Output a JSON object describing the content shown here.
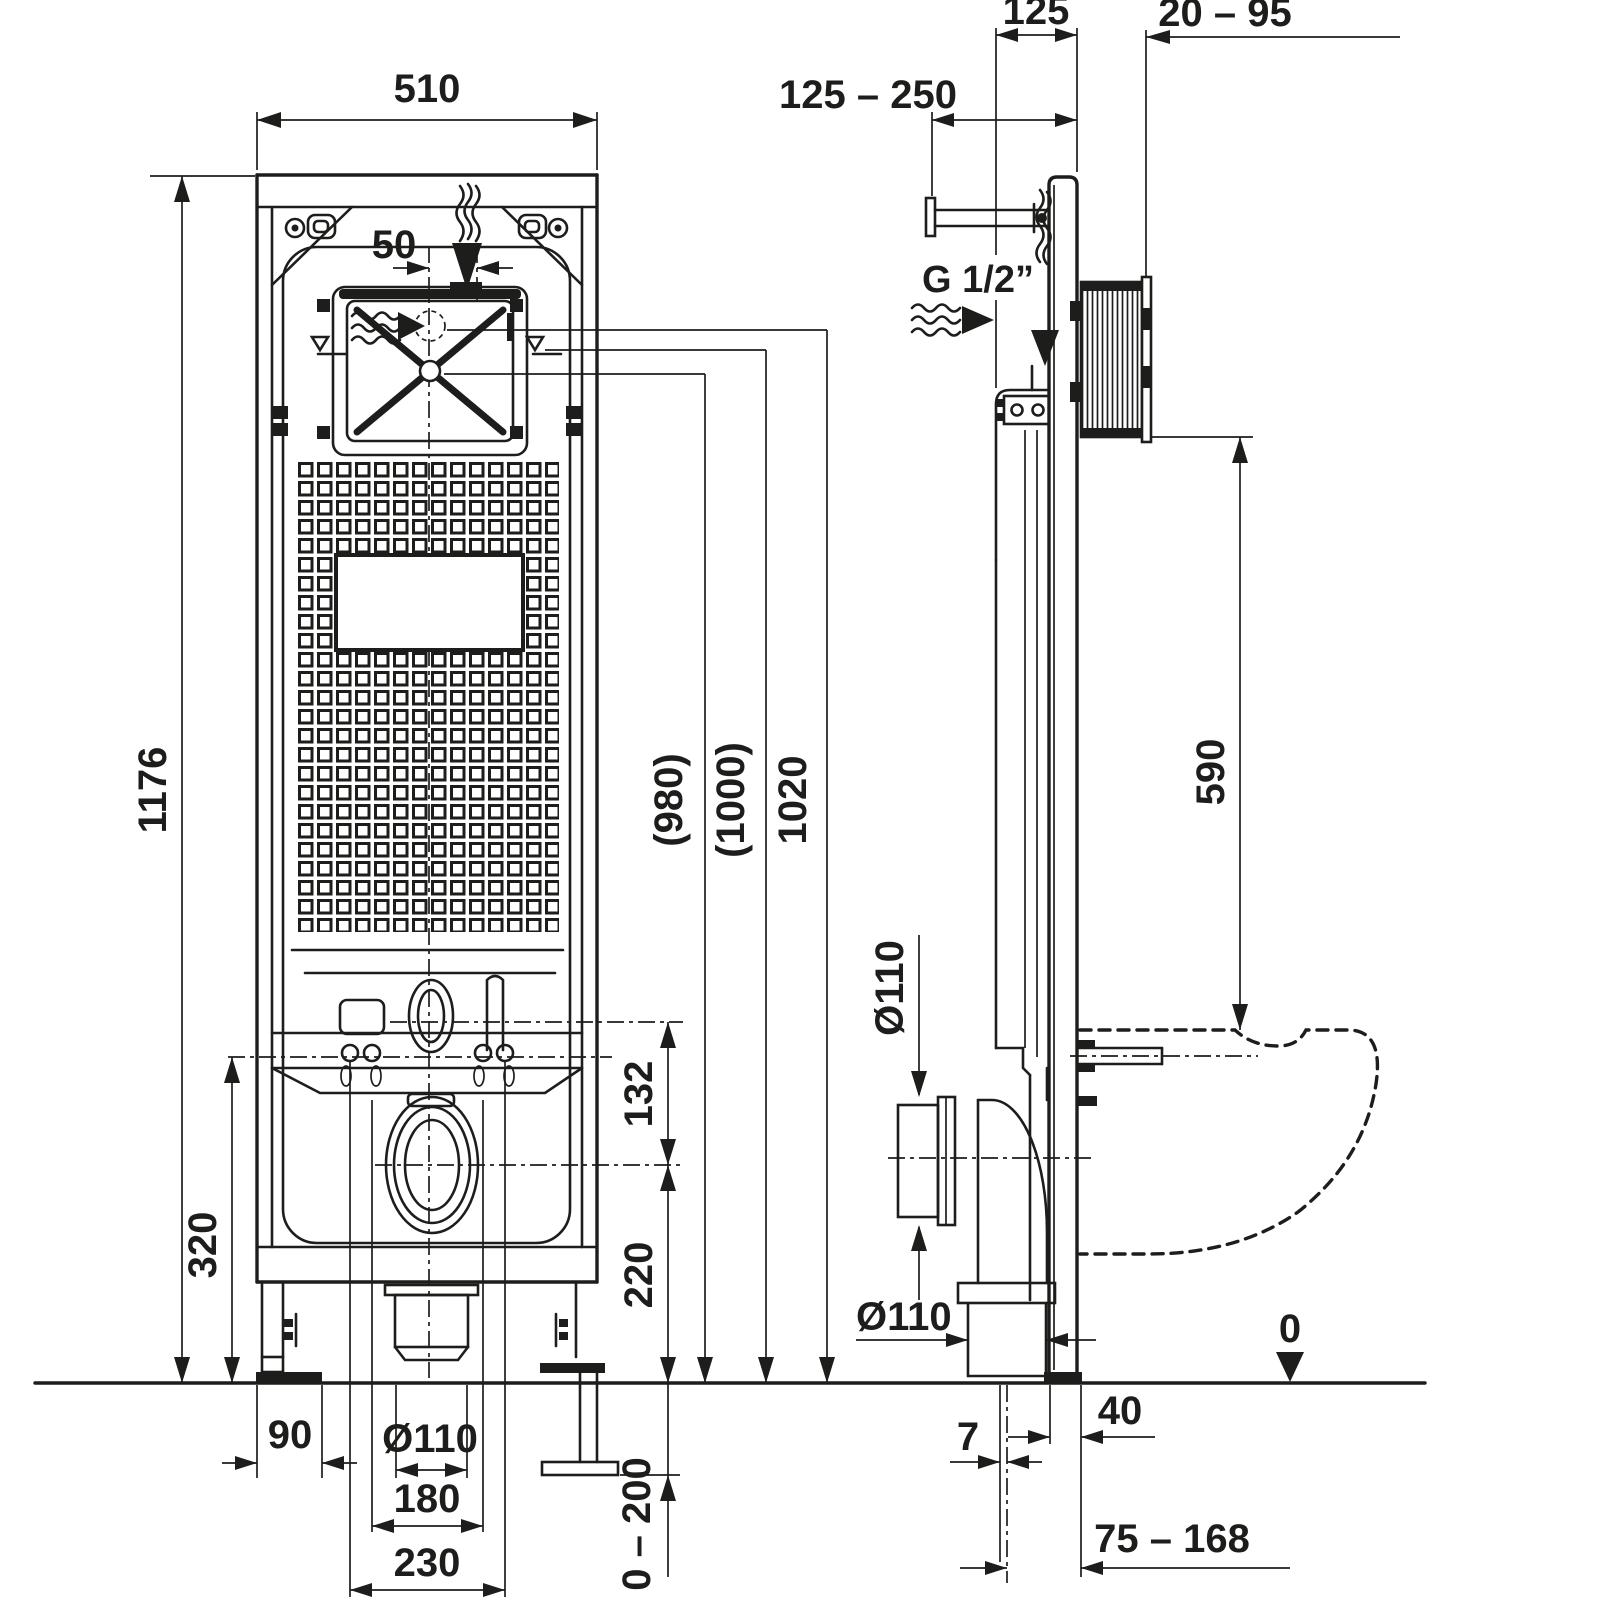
{
  "drawing": {
    "type": "installation-dimension-drawing",
    "subject": "wall-hung WC concealed cistern mounting frame, front view and side view",
    "front_view": {
      "dims": {
        "overall_width": "510",
        "inlet_offset": "50",
        "overall_height": "1176",
        "height_1020": "1020",
        "height_1000": "(1000)",
        "height_980": "(980)",
        "flush_to_drain": "132",
        "drain_axis_height": "220",
        "bracket_axis_height": "320",
        "foot_plate_width": "90",
        "drain_diameter": "Ø110",
        "rod_spacing": "180",
        "bolt_spacing": "230",
        "foot_adjust_range": "0 – 200"
      }
    },
    "side_view": {
      "dims": {
        "frame_depth": "125",
        "housing_range": "20 – 95",
        "wall_anchor_range": "125 – 250",
        "water_inlet_thread": "G 1/2”",
        "bowl_height": "590",
        "outlet_diameter_side": "Ø110",
        "outlet_diameter_bottom": "Ø110",
        "pipe_offset": "7",
        "foot_depth": "40",
        "drain_axis_to_wall": "75 – 168",
        "floor_level": "0"
      }
    }
  }
}
